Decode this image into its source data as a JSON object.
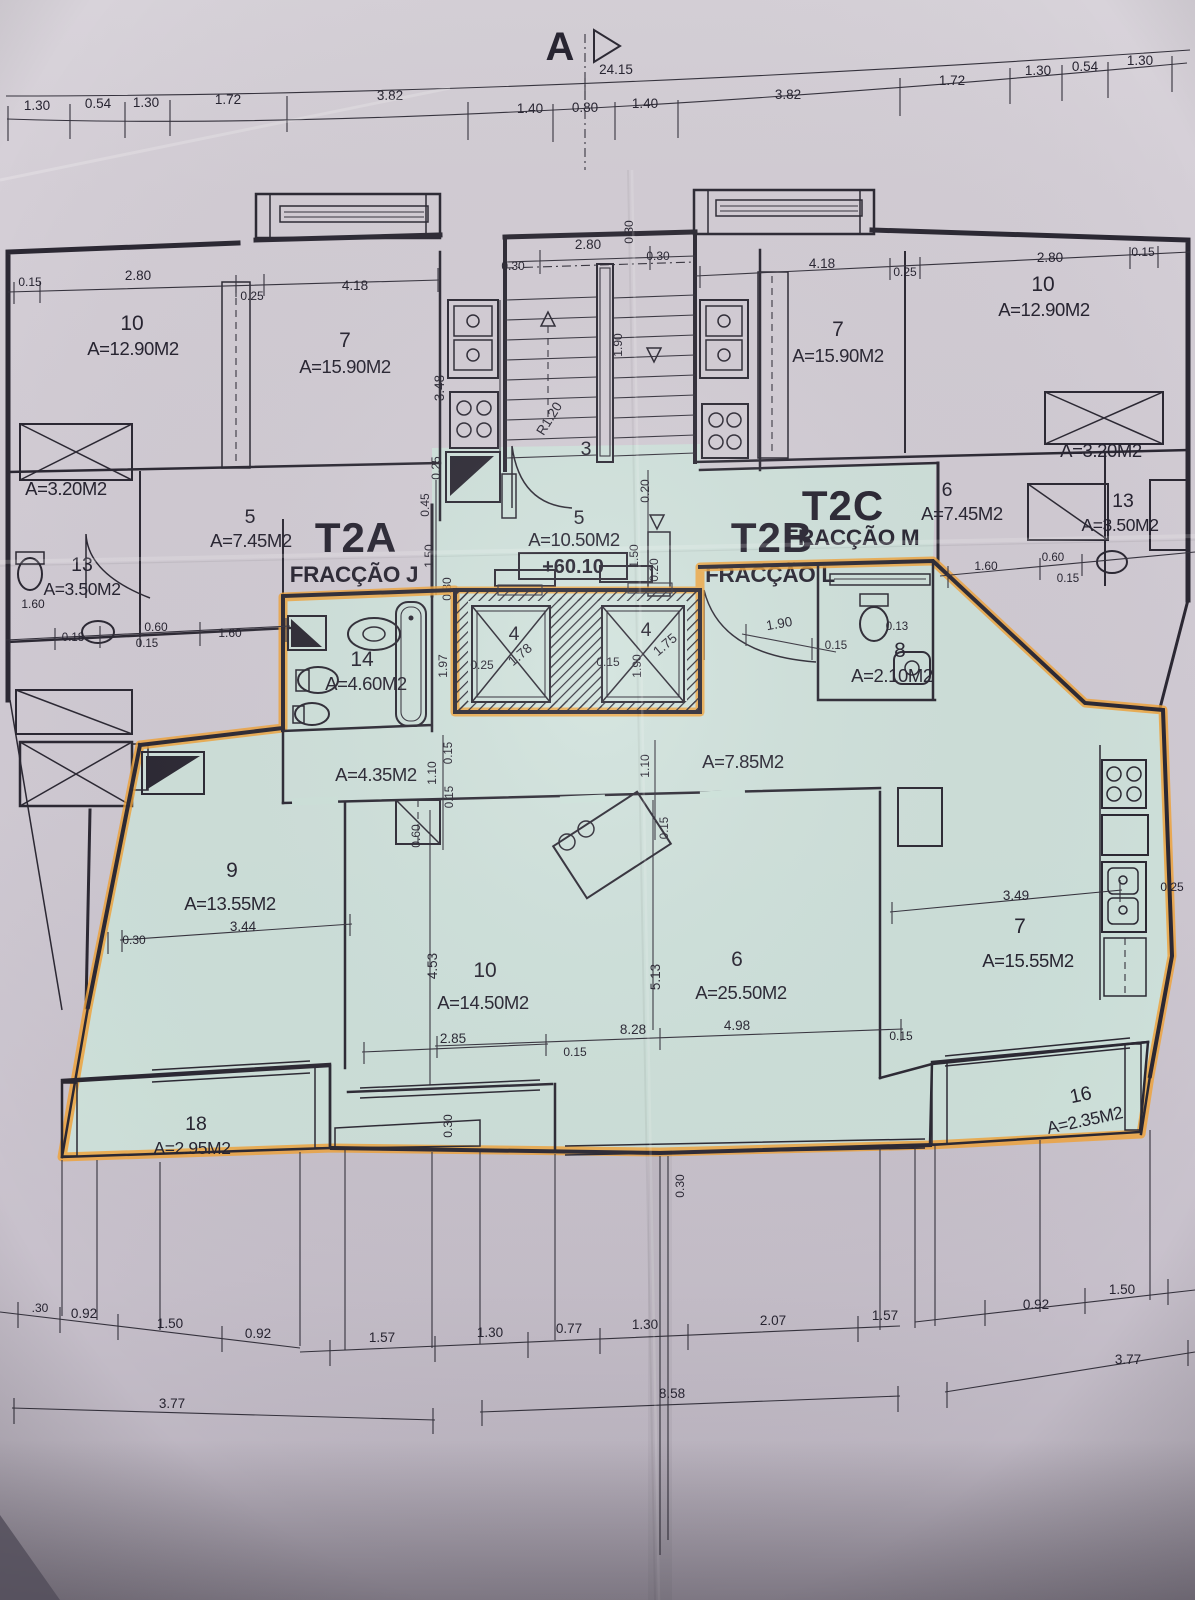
{
  "section": {
    "label": "A"
  },
  "level": "+60.10",
  "units": {
    "t2a": {
      "code": "T2A",
      "fraccao": "FRACÇÃO J"
    },
    "t2b": {
      "code": "T2B",
      "fraccao": "FRACÇÃO L"
    },
    "t2c": {
      "code": "T2C",
      "fraccao": "FRACÇÃO M"
    }
  },
  "rooms": {
    "ul_10": {
      "num": "10",
      "area": "A=12.90M2"
    },
    "ul_7": {
      "num": "7",
      "area": "A=15.90M2"
    },
    "ul_storage": {
      "area": "A=3.20M2"
    },
    "ul_5": {
      "num": "5",
      "area": "A=7.45M2"
    },
    "ul_13": {
      "num": "13",
      "area": "A=3.50M2"
    },
    "ur_10": {
      "num": "10",
      "area": "A=12.90M2"
    },
    "ur_7": {
      "num": "7",
      "area": "A=15.90M2"
    },
    "ur_storage": {
      "area": "A=3.20M2"
    },
    "ur_6": {
      "num": "6",
      "area": "A=7.45M2"
    },
    "ur_13": {
      "num": "13",
      "area": "A=3.50M2"
    },
    "landing": {
      "num": "5",
      "area": "A=10.50M2"
    },
    "stair_flight": {
      "num": "3"
    },
    "bath": {
      "num": "14",
      "area": "A=4.60M2"
    },
    "wc": {
      "num": "8",
      "area": "A=2.10M2"
    },
    "hall": {
      "area": "A=4.35M2"
    },
    "corridor": {
      "area": "A=7.85M2"
    },
    "bed9": {
      "num": "9",
      "area": "A=13.55M2"
    },
    "bed10": {
      "num": "10",
      "area": "A=14.50M2"
    },
    "living": {
      "num": "6",
      "area": "A=25.50M2"
    },
    "kitchen": {
      "num": "7",
      "area": "A=15.55M2"
    },
    "balcony_l": {
      "num": "18",
      "area": "A=2.95M2"
    },
    "balcony_r": {
      "num": "16",
      "area": "A=2.35M2"
    },
    "lift1": {
      "num": "4",
      "w": "1.78"
    },
    "lift2": {
      "num": "4",
      "w": "1.75"
    }
  },
  "dims": {
    "top_overall": "24.15",
    "top_row": [
      "1.30",
      "0.54",
      "1.30",
      "1.72",
      "3.82",
      "1.40",
      "0.80",
      "1.40",
      "3.82",
      "1.72",
      "1.30",
      "0.54",
      "1.30"
    ],
    "ul": [
      "0.15",
      "2.80",
      "0.25",
      "4.18",
      "3.48",
      "0.25"
    ],
    "ur": [
      "4.18",
      "0.25",
      "2.80",
      "0.15"
    ],
    "stair": [
      "0.30",
      "2.80",
      "0.30",
      "0.30",
      "1.90",
      "R1.20"
    ],
    "landing": [
      "0.45",
      "1.50",
      "0.30",
      "0.20",
      "1.50",
      "0.20"
    ],
    "left_mid": [
      "1.60",
      "0.18",
      "0.60",
      "0.15",
      "1.60"
    ],
    "right_mid": [
      "1.60",
      "0.60",
      "0.15"
    ],
    "bath": [
      "1.97",
      "0.25"
    ],
    "lifts": [
      "0.15",
      "1.90"
    ],
    "wc": [
      "1.90",
      "0.15",
      "0.13"
    ],
    "hall": [
      "0.15",
      "1.10",
      "0.15",
      "0.60"
    ],
    "corridor": [
      "1.10",
      "0.15"
    ],
    "bed9": [
      "3.44",
      "0.30"
    ],
    "bed10": [
      "4.53",
      "2.85",
      "0.15"
    ],
    "living": [
      "5.13",
      "8.28",
      "4.98",
      "0.15"
    ],
    "kitchen": [
      "3.49",
      "0.25"
    ],
    "bottom_v": [
      "0.30",
      "0.30"
    ],
    "b_row1": [
      ".30",
      "0.92",
      "1.50",
      "0.92",
      "1.57",
      "1.30",
      "0.77",
      "1.30",
      "2.07",
      "1.57",
      "0.92",
      "1.50"
    ],
    "b_row2": [
      "3.77",
      "8.58",
      "3.77"
    ]
  },
  "colors": {
    "paper": "#d3cdd5",
    "highlight_teal": "#cfe4dc",
    "highlight_orange": "#f1a338",
    "ink": "#2b2833"
  }
}
